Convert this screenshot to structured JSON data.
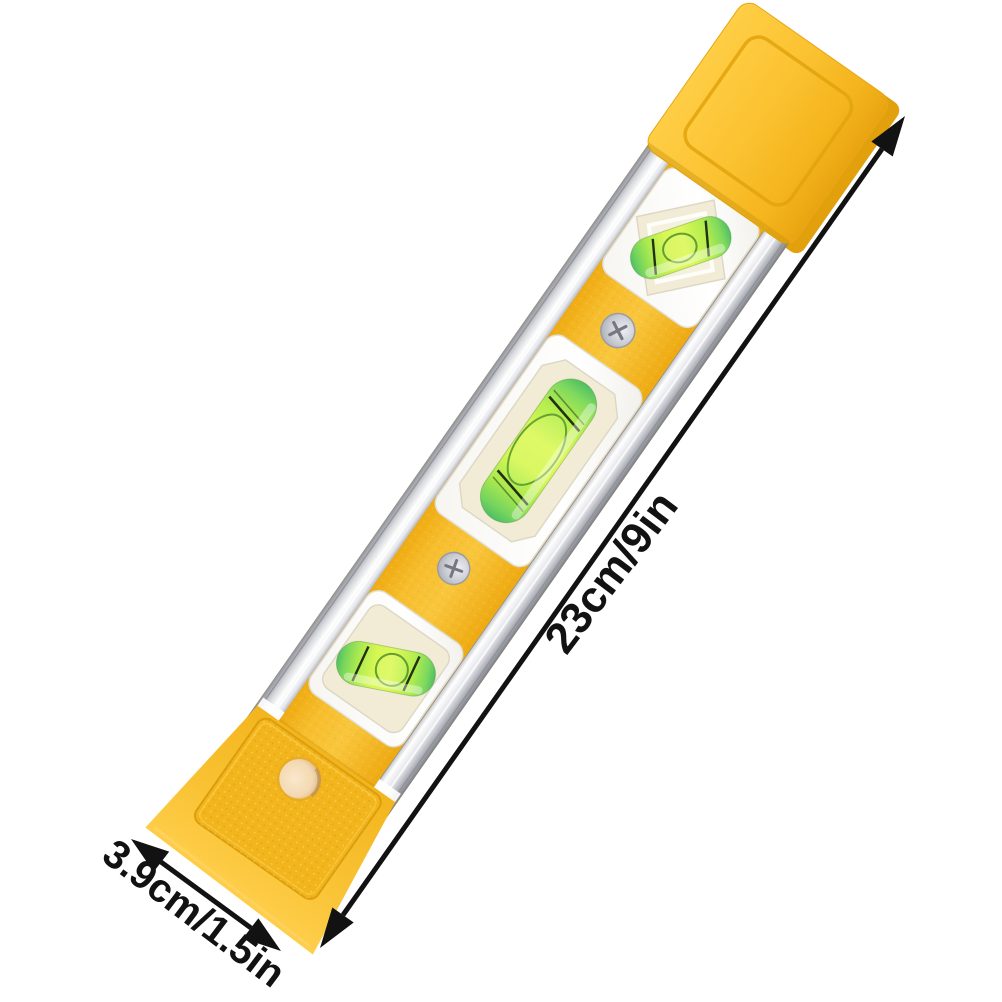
{
  "scene": {
    "background": "#ffffff",
    "description": "Yellow torpedo spirit level with aluminum side rails and three green bubble vials, photographed diagonally on white with dimension arrows"
  },
  "annotations": {
    "length_label": "23cm/9in",
    "width_label": "3.9cm/1.5in"
  },
  "colors": {
    "body_yellow": "#F7BE2A",
    "body_yellow_bright": "#FFCE45",
    "body_yellow_dark": "#E5A30F",
    "rail_silver_light": "#F2F3F5",
    "rail_silver_dark": "#8F9198",
    "window_white": "#FCFCFA",
    "recess_cream": "#F2ECD6",
    "vial_green": "#D6F74E",
    "vial_green_dark": "#55C468",
    "hole_interior": "#F7DFC0",
    "annotation_black": "#121212"
  }
}
